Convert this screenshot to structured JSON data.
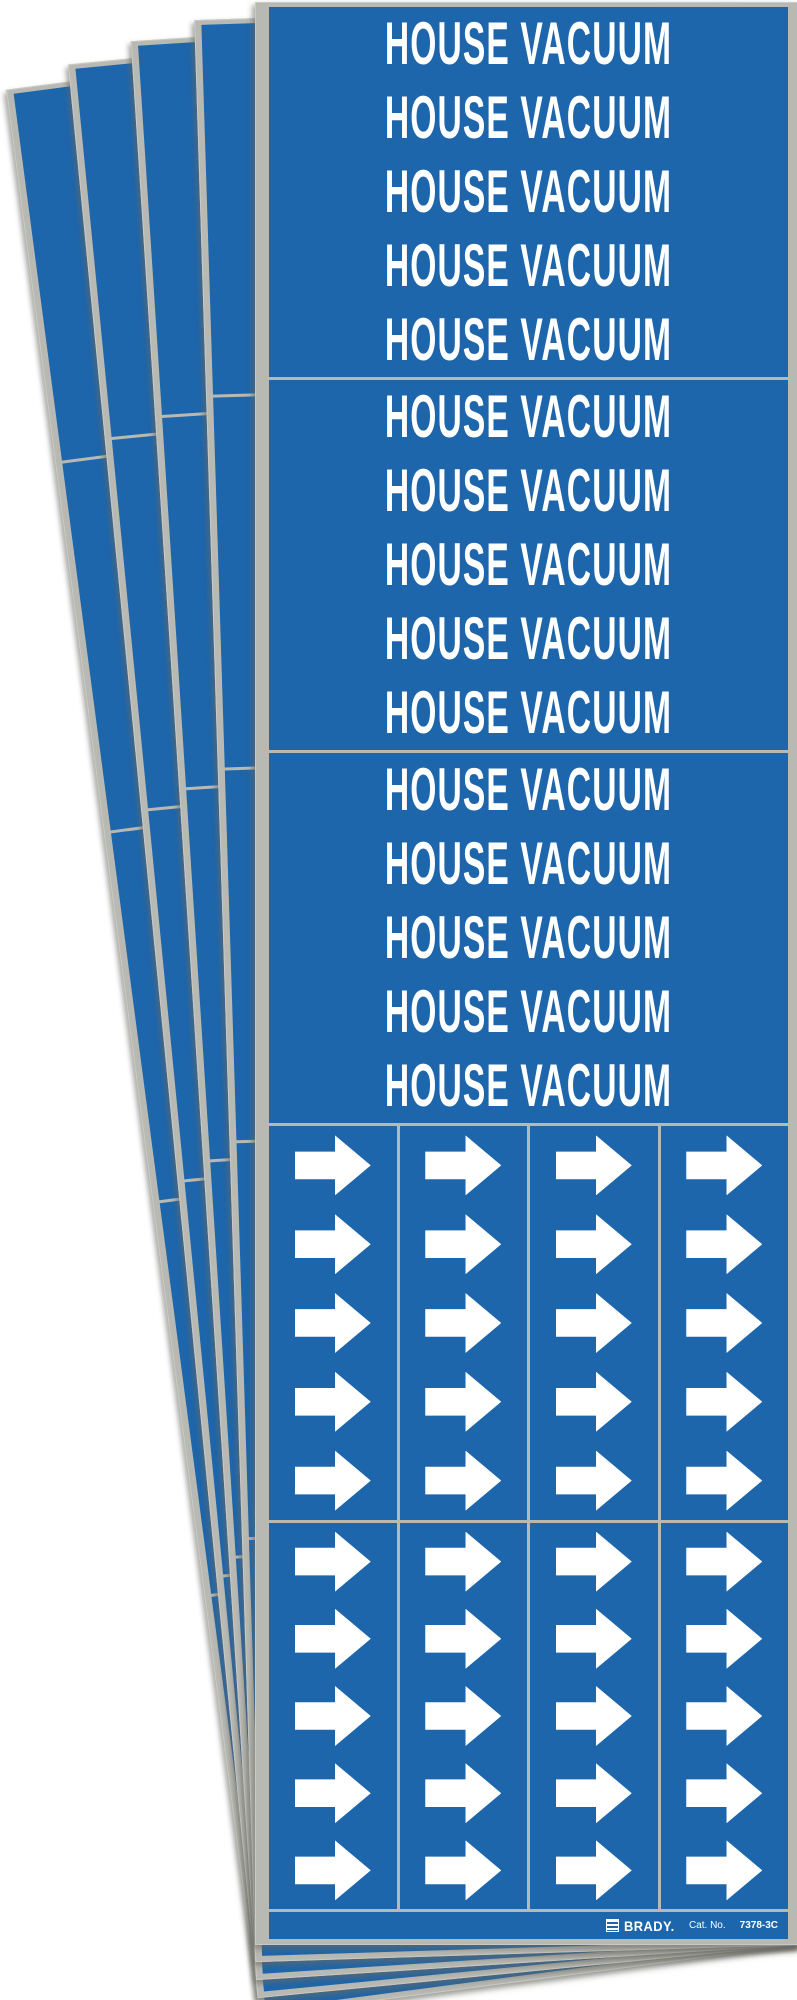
{
  "photo": {
    "description": "Fanned stack of identical blue self-sticking pipe marker label sheets",
    "background": "#ffffff"
  },
  "stack": {
    "sheet_count": 5,
    "rotations_deg": [
      -7.5,
      -5.6,
      -3.7,
      -1.8,
      0
    ]
  },
  "sheet": {
    "marker_text": "HOUSE VACUUM",
    "text_section_count": 3,
    "text_rows_per_section": 5,
    "arrow_section_count": 2,
    "arrow_rows": 5,
    "arrow_columns": 4,
    "arrow_icon": "flow-arrow-icon",
    "footer": {
      "brand": "BRADY.",
      "cat_label": "Cat. No.",
      "cat_no": "7378-3C"
    }
  },
  "colors": {
    "marker_blue": "#1e66ab",
    "marker_white": "#ffffff",
    "liner_gray": "#b9b9b4",
    "edge_gray": "#c9c9c5"
  }
}
